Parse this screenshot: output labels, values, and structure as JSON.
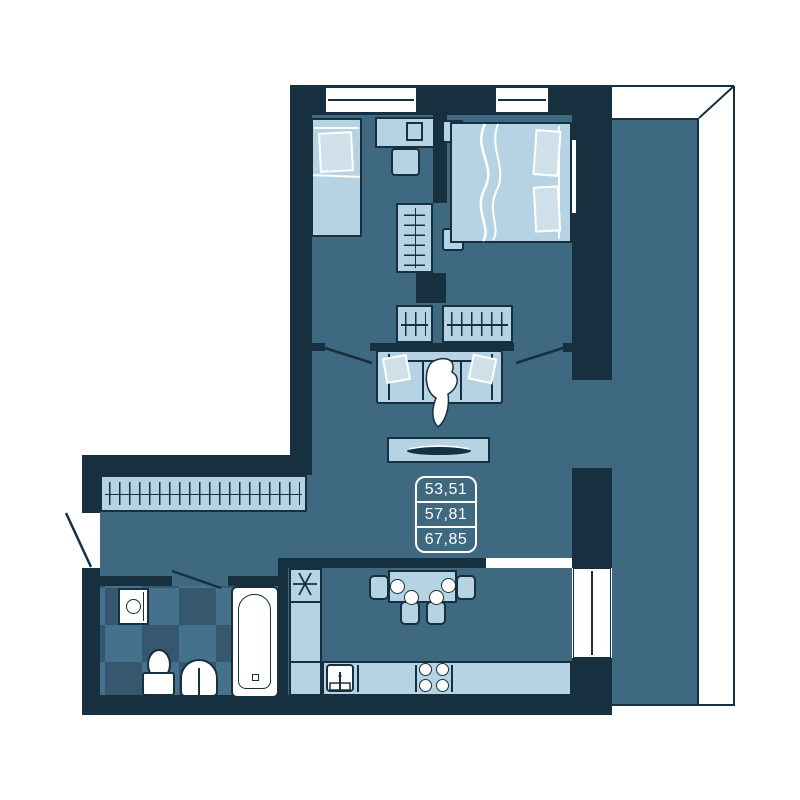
{
  "plan": {
    "area_values": [
      "53,51",
      "57,81",
      "67,85"
    ],
    "colors": {
      "wall": "#16303f",
      "floor": "#3f6980",
      "furniture": "#b5d3e2",
      "tile_light": "#45718c",
      "tile_dark": "#35586e",
      "line_white": "#ffffff"
    },
    "symbols": {
      "fridge": "six-spoke-asterisk-icon",
      "wardrobe": "rail-with-hangers-icon"
    }
  }
}
